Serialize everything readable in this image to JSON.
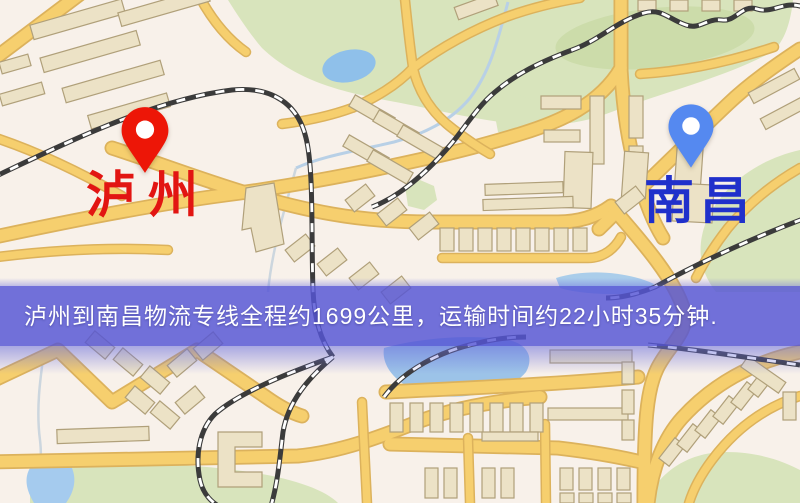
{
  "map": {
    "origin": {
      "name": "泸州",
      "marker_icon": "red-map-pin-icon",
      "marker_color": "#ed1607",
      "label_color": "#e21512"
    },
    "destination": {
      "name": "南昌",
      "marker_icon": "blue-map-pin-icon",
      "marker_color": "#5589f0",
      "label_color": "#2030cb"
    },
    "banner": {
      "text": "泸州到南昌物流专线全程约1699公里，运输时间约22小时35分钟.",
      "route_distance": "约1699公里",
      "transport_time": "约22小时35分钟",
      "background_color": "#5656d5",
      "text_color": "#ffffff"
    },
    "map_colors": {
      "background": "#f8f1ea",
      "road_fill": "#f6cf6e",
      "road_edge": "#dcb25c",
      "building_fill": "#ece2c6",
      "building_edge": "#b0a07a",
      "park": "#d8e4bc",
      "water": "#9cc3e8",
      "railway": "#3b3b3b"
    }
  }
}
